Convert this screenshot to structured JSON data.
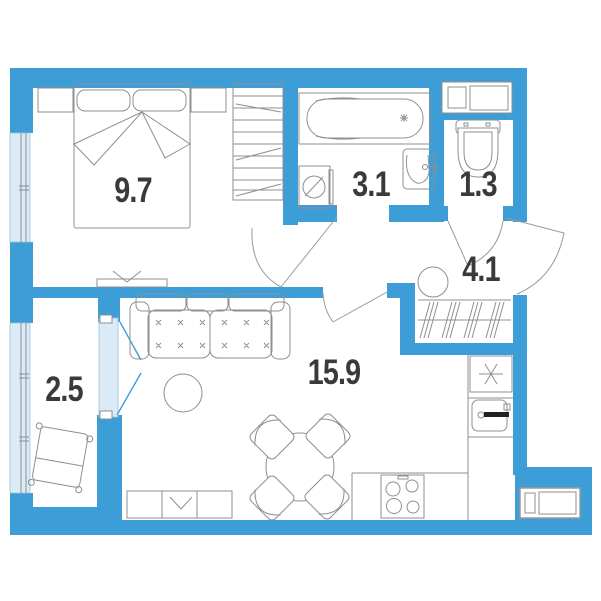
{
  "plan": {
    "title": "apartment-floor-plan",
    "rooms": [
      {
        "id": "bedroom",
        "area": "9.7"
      },
      {
        "id": "bathroom",
        "area": "3.1"
      },
      {
        "id": "wc",
        "area": "1.3"
      },
      {
        "id": "hallway",
        "area": "4.1"
      },
      {
        "id": "balcony",
        "area": "2.5"
      },
      {
        "id": "living-kitchen",
        "area": "15.9"
      }
    ],
    "colors": {
      "wall": "#3d9ed7",
      "glazing": "#daebf7",
      "furniture_line": "#8f8f8f",
      "label_text": "#3a3a3a"
    }
  }
}
